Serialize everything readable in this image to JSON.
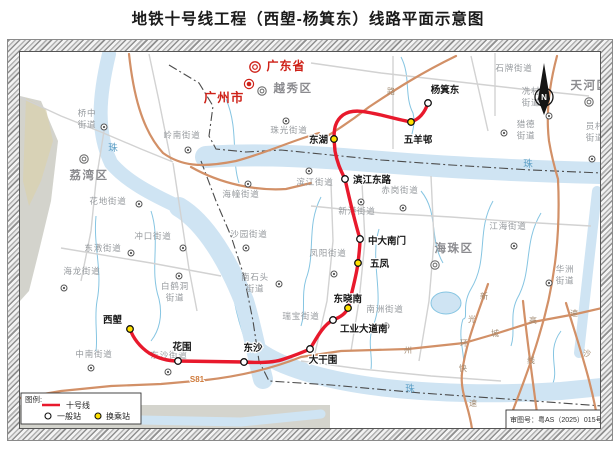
{
  "title": "地铁十号线工程（西塱-杨箕东）线路平面示意图",
  "legend": {
    "heading": "图例:",
    "line_label": "十号线",
    "regular_label": "一般站",
    "transfer_label": "换乘站"
  },
  "approval_note": "审图号：粤AS（2025）015号",
  "compass_label": "N",
  "colors": {
    "metro_line": "#e8192c",
    "transfer_station_fill": "#ffe100",
    "regular_station_fill": "#ffffff",
    "river": "#cfe4f3",
    "major_road": "#d29067",
    "red_label": "#ce2118"
  },
  "map": {
    "stations": [
      {
        "name": "西塱",
        "type": "transfer",
        "x": 129,
        "y": 328,
        "lx": 121,
        "ly": 322,
        "anchor": "end"
      },
      {
        "name": "花围",
        "type": "regular",
        "x": 177,
        "y": 360,
        "lx": 181,
        "ly": 349,
        "anchor": "middle"
      },
      {
        "name": "东沙",
        "type": "regular",
        "x": 243,
        "y": 361,
        "lx": 252,
        "ly": 350,
        "anchor": "middle"
      },
      {
        "name": "大干围",
        "type": "regular",
        "x": 309,
        "y": 348,
        "lx": 322,
        "ly": 362,
        "anchor": "middle"
      },
      {
        "name": "工业大道南",
        "type": "regular",
        "x": 332,
        "y": 319,
        "lx": 339,
        "ly": 331,
        "anchor": "start"
      },
      {
        "name": "东晓南",
        "type": "transfer",
        "x": 347,
        "y": 307,
        "lx": 361,
        "ly": 301,
        "anchor": "end"
      },
      {
        "name": "五凤",
        "type": "transfer",
        "x": 357,
        "y": 262,
        "lx": 369,
        "ly": 266,
        "anchor": "start"
      },
      {
        "name": "中大南门",
        "type": "regular",
        "x": 359,
        "y": 238,
        "lx": 367,
        "ly": 243,
        "anchor": "start"
      },
      {
        "name": "滨江东路",
        "type": "regular",
        "x": 344,
        "y": 178,
        "lx": 352,
        "ly": 182,
        "anchor": "start"
      },
      {
        "name": "东湖",
        "type": "transfer",
        "x": 333,
        "y": 138,
        "lx": 327,
        "ly": 142,
        "anchor": "end"
      },
      {
        "name": "五羊邨",
        "type": "transfer",
        "x": 410,
        "y": 121,
        "lx": 417,
        "ly": 142,
        "anchor": "middle"
      },
      {
        "name": "杨箕东",
        "type": "regular",
        "x": 427,
        "y": 102,
        "lx": 444,
        "ly": 92,
        "anchor": "middle"
      }
    ],
    "area_labels": [
      {
        "lines": [
          "桥中",
          "街道"
        ],
        "x": 86,
        "y": 115,
        "cls": "street"
      },
      {
        "lines": [
          "岭南街道"
        ],
        "x": 181,
        "y": 137,
        "cls": "street"
      },
      {
        "lines": [
          "珠光街道"
        ],
        "x": 288,
        "y": 132,
        "cls": "street"
      },
      {
        "lines": [
          "花地街道"
        ],
        "x": 107,
        "y": 203,
        "cls": "street"
      },
      {
        "lines": [
          "海幢街道"
        ],
        "x": 240,
        "y": 196,
        "cls": "street"
      },
      {
        "lines": [
          "沙园街道"
        ],
        "x": 248,
        "y": 236,
        "cls": "street"
      },
      {
        "lines": [
          "冲口街道"
        ],
        "x": 152,
        "y": 238,
        "cls": "street"
      },
      {
        "lines": [
          "东漖街道"
        ],
        "x": 102,
        "y": 250,
        "cls": "street"
      },
      {
        "lines": [
          "海龙街道"
        ],
        "x": 81,
        "y": 273,
        "cls": "street"
      },
      {
        "lines": [
          "白鹤洞",
          "街道"
        ],
        "x": 174,
        "y": 288,
        "cls": "street"
      },
      {
        "lines": [
          "南石头",
          "街道"
        ],
        "x": 254,
        "y": 279,
        "cls": "street"
      },
      {
        "lines": [
          "瑞宝街道"
        ],
        "x": 300,
        "y": 318,
        "cls": "street"
      },
      {
        "lines": [
          "中南街道"
        ],
        "x": 93,
        "y": 356,
        "cls": "street"
      },
      {
        "lines": [
          "东沙街道"
        ],
        "x": 168,
        "y": 357,
        "cls": "street"
      },
      {
        "lines": [
          "凤阳街道"
        ],
        "x": 327,
        "y": 255,
        "cls": "street"
      },
      {
        "lines": [
          "南洲街道"
        ],
        "x": 384,
        "y": 311,
        "cls": "street"
      },
      {
        "lines": [
          "新港街道"
        ],
        "x": 356,
        "y": 213,
        "cls": "street"
      },
      {
        "lines": [
          "赤岗街道"
        ],
        "x": 399,
        "y": 192,
        "cls": "street"
      },
      {
        "lines": [
          "滨江街道"
        ],
        "x": 314,
        "y": 184,
        "cls": "street"
      },
      {
        "lines": [
          "江海街道"
        ],
        "x": 507,
        "y": 228,
        "cls": "street"
      },
      {
        "lines": [
          "华洲",
          "街道"
        ],
        "x": 564,
        "y": 271,
        "cls": "street"
      },
      {
        "lines": [
          "石牌街道"
        ],
        "x": 513,
        "y": 70,
        "cls": "street"
      },
      {
        "lines": [
          "冼村",
          "街道"
        ],
        "x": 530,
        "y": 93,
        "cls": "street"
      },
      {
        "lines": [
          "猎德",
          "街道"
        ],
        "x": 525,
        "y": 126,
        "cls": "street"
      },
      {
        "lines": [
          "员村",
          "街道"
        ],
        "x": 594,
        "y": 128,
        "cls": "street"
      },
      {
        "lines": [
          "荔湾区"
        ],
        "x": 88,
        "y": 178,
        "cls": "district"
      },
      {
        "lines": [
          "越秀区"
        ],
        "x": 292,
        "y": 91,
        "cls": "district"
      },
      {
        "lines": [
          "海珠区"
        ],
        "x": 453,
        "y": 251,
        "cls": "district"
      },
      {
        "lines": [
          "天河区"
        ],
        "x": 589,
        "y": 88,
        "cls": "district"
      },
      {
        "lines": [
          "广东省"
        ],
        "x": 285,
        "y": 69,
        "cls": "province"
      },
      {
        "lines": [
          "广州市"
        ],
        "x": 223,
        "y": 101,
        "cls": "city"
      },
      {
        "lines": [
          "珠"
        ],
        "x": 112,
        "y": 150,
        "cls": "river"
      },
      {
        "lines": [
          "珠"
        ],
        "x": 527,
        "y": 166,
        "cls": "river"
      },
      {
        "lines": [
          "珠"
        ],
        "x": 409,
        "y": 391,
        "cls": "river"
      },
      {
        "lines": [
          "路"
        ],
        "x": 390,
        "y": 93,
        "cls": "road"
      },
      {
        "lines": [
          "州"
        ],
        "x": 407,
        "y": 352,
        "cls": "road"
      },
      {
        "lines": [
          "环"
        ],
        "x": 463,
        "y": 345,
        "cls": "road"
      },
      {
        "lines": [
          "城"
        ],
        "x": 494,
        "y": 335,
        "cls": "road"
      },
      {
        "lines": [
          "高"
        ],
        "x": 532,
        "y": 322,
        "cls": "road"
      },
      {
        "lines": [
          "速"
        ],
        "x": 573,
        "y": 315,
        "cls": "road"
      },
      {
        "lines": [
          "新"
        ],
        "x": 483,
        "y": 298,
        "cls": "road"
      },
      {
        "lines": [
          "光"
        ],
        "x": 471,
        "y": 321,
        "cls": "road"
      },
      {
        "lines": [
          "快"
        ],
        "x": 462,
        "y": 370,
        "cls": "road"
      },
      {
        "lines": [
          "速"
        ],
        "x": 472,
        "y": 405,
        "cls": "road"
      },
      {
        "lines": [
          "线"
        ],
        "x": 530,
        "y": 362,
        "cls": "road"
      },
      {
        "lines": [
          "沙"
        ],
        "x": 586,
        "y": 355,
        "cls": "road"
      },
      {
        "lines": [
          "S81"
        ],
        "x": 196,
        "y": 381,
        "cls": "roadnum"
      }
    ],
    "markers": [
      {
        "x": 103,
        "y": 126,
        "kind": "office"
      },
      {
        "x": 187,
        "y": 149,
        "kind": "office"
      },
      {
        "x": 285,
        "y": 120,
        "kind": "office"
      },
      {
        "x": 138,
        "y": 203,
        "kind": "office"
      },
      {
        "x": 247,
        "y": 183,
        "kind": "office"
      },
      {
        "x": 245,
        "y": 247,
        "kind": "office"
      },
      {
        "x": 182,
        "y": 247,
        "kind": "office"
      },
      {
        "x": 130,
        "y": 252,
        "kind": "office"
      },
      {
        "x": 63,
        "y": 287,
        "kind": "office"
      },
      {
        "x": 178,
        "y": 275,
        "kind": "office"
      },
      {
        "x": 278,
        "y": 283,
        "kind": "office"
      },
      {
        "x": 90,
        "y": 367,
        "kind": "office"
      },
      {
        "x": 167,
        "y": 371,
        "kind": "office"
      },
      {
        "x": 333,
        "y": 273,
        "kind": "office"
      },
      {
        "x": 385,
        "y": 325,
        "kind": "office"
      },
      {
        "x": 360,
        "y": 201,
        "kind": "office"
      },
      {
        "x": 402,
        "y": 207,
        "kind": "office"
      },
      {
        "x": 308,
        "y": 170,
        "kind": "office"
      },
      {
        "x": 513,
        "y": 245,
        "kind": "office"
      },
      {
        "x": 548,
        "y": 282,
        "kind": "office"
      },
      {
        "x": 548,
        "y": 115,
        "kind": "office"
      },
      {
        "x": 503,
        "y": 132,
        "kind": "office"
      },
      {
        "x": 591,
        "y": 158,
        "kind": "office"
      },
      {
        "x": 83,
        "y": 158,
        "kind": "district"
      },
      {
        "x": 261,
        "y": 90,
        "kind": "district"
      },
      {
        "x": 588,
        "y": 101,
        "kind": "district"
      },
      {
        "x": 434,
        "y": 264,
        "kind": "district"
      },
      {
        "x": 254,
        "y": 66,
        "kind": "province"
      },
      {
        "x": 248,
        "y": 83,
        "kind": "city"
      }
    ]
  }
}
